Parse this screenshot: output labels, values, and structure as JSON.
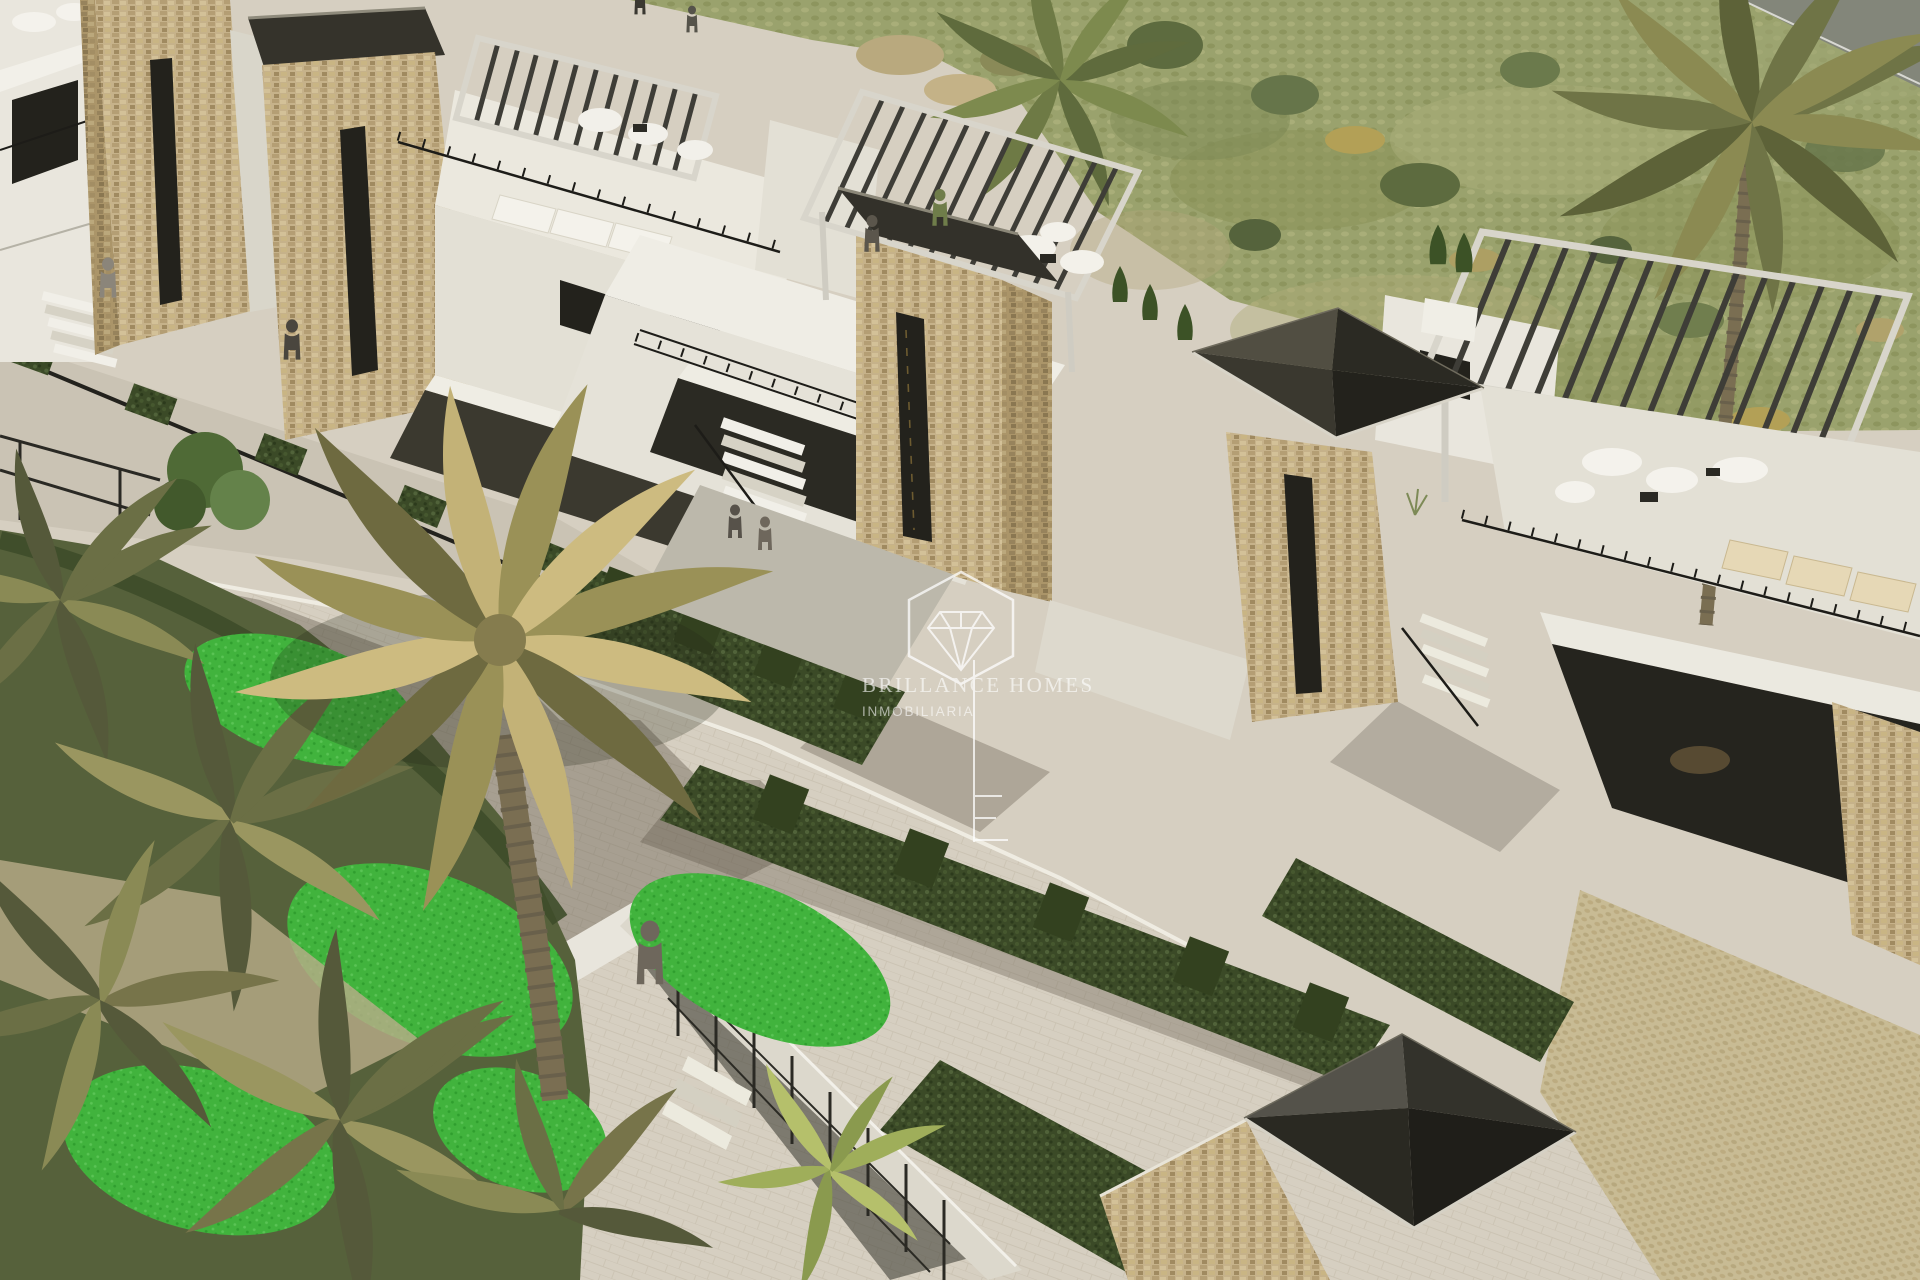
{
  "watermark": {
    "brand_line": "BRILLANCE HOMES",
    "sub_line": "INMOBILIARIA",
    "logo_icons": [
      "hexagon-outline",
      "diamond-gem",
      "mast-with-ticks"
    ]
  },
  "colors": {
    "road": "#d6cfc1",
    "sidewalk": "#cac3b4",
    "field": "#9aa26d",
    "field_gray": "#83867a",
    "lawn": "#41b33d",
    "garden": "#56613b",
    "white_wall": "#e9e6dd",
    "wall_shade": "#d9d6ca",
    "wall_dark": "#a9a699",
    "opening": "#23221c",
    "porch": "#3b392f",
    "stone": "#c6b28a",
    "stone_shade": "#ab9569",
    "pergola_slat": "#3e3d37",
    "pergola_frame": "#d8d5cb",
    "hedge": "#3b4a27",
    "hedge_dark": "#33411f",
    "rail": "#1d1c18",
    "glass": "#33312a",
    "palm_dark": "#6e6a40",
    "palm_mid": "#9a9157",
    "palm_light": "#c3b277",
    "palm_gold": "#cdbb80",
    "trunk": "#7a6e52",
    "cypress": "#3c5226",
    "watermark": "#ffffff"
  }
}
